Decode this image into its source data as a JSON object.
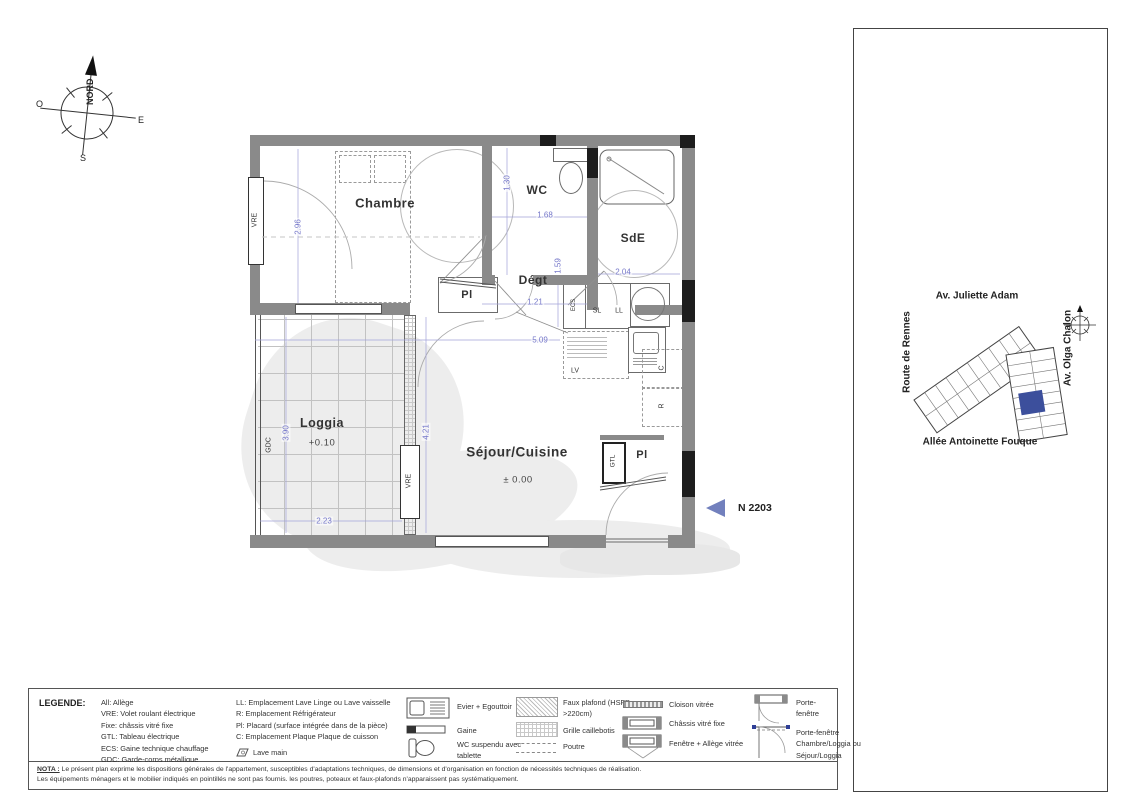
{
  "colors": {
    "logo_purple": "#433d92",
    "dim_blue": "#7577c9",
    "unit_blue": "#5463ae",
    "scalebar_blue": "#2f3f96"
  },
  "compass": {
    "north": "NORD",
    "west": "O",
    "east": "E",
    "south": "S"
  },
  "plan": {
    "rooms": {
      "chambre": "Chambre",
      "wc": "WC",
      "sde": "SdE",
      "degt": "Dégt",
      "sejour": "Séjour/Cuisine",
      "sejour_level": "± 0.00",
      "loggia": "Loggia",
      "loggia_level": "+0.10",
      "pl_chambre": "Pl",
      "pl_entree": "Pl"
    },
    "tags": {
      "vre_left": "VRE",
      "vre_loggia": "VRE",
      "gdc": "GDC",
      "gtl": "GTL",
      "ecs": "ECS",
      "sl": "SL",
      "ll": "LL",
      "lv": "LV",
      "c": "C",
      "r": "R"
    },
    "dims": {
      "chambre_height": "2.96",
      "wc_height": "1.30",
      "wc_width": "1.68",
      "sde_width": "2.04",
      "degt_depth": "1.59",
      "degt_width": "1.21",
      "plan_width": "5.09",
      "loggia_height": "3.90",
      "loggia_width": "2.23",
      "sejour_height": "4.21"
    },
    "unit_marker": "N 2203"
  },
  "panel": {
    "logo_letters": [
      "L",
      "a",
      "ø",
      "m",
      "e"
    ],
    "partners": {
      "bati": "BATI-NANTES",
      "bati_sub": "BÂTISSEURS D'AVENIR",
      "marignan": "Marignan"
    },
    "ilot": "ILOT 1",
    "address": "5 Allée Antoinette Fouque",
    "unit_row": {
      "type": "Type 2",
      "niveau": "Niveau 2",
      "logement": "Logement N 2203"
    },
    "site": {
      "top": "Av. Juliette Adam",
      "left": "Route de Rennes",
      "right": "Av. Olga Chalon",
      "bottom": "Allée Antoinette Fouque"
    },
    "surfaces": {
      "title": "Surfaces habitables",
      "rows": [
        {
          "label": "Séjour/Cuisine",
          "value": "21.05 m²"
        },
        {
          "label": "Chambre",
          "value": "12.25 m²"
        },
        {
          "label": "Dégagement",
          "value": "1.92 m²"
        },
        {
          "label": "Salle d'eau",
          "value": "4.66 m²"
        },
        {
          "label": "WC",
          "value": "2.22 m²"
        }
      ],
      "total_label": "SURFACE TOTALE",
      "total_value": "42.10 m²",
      "loggia_label": "Loggia",
      "loggia_value": "8.69 m²"
    },
    "doc": {
      "title": "PLAN DE VENTE",
      "scale_ticks": [
        "0",
        "1",
        "2",
        "3",
        "4"
      ],
      "edition_label": "Édition:",
      "edition_value": "26 Avril 2023",
      "indice_label": "Indice:",
      "indice_value": "0"
    }
  },
  "legend": {
    "title": "LEGENDE:",
    "abbr1": [
      "All: Allège",
      "VRE: Volet roulant électrique",
      "Fixe: châssis vitré fixe",
      "GTL: Tableau électrique",
      "ECS: Gaine technique chauffage",
      "GDC: Garde-corps métallique"
    ],
    "abbr2": [
      "LL: Emplacement Lave Linge ou Lave vaisselle",
      "R: Emplacement Réfrigérateur",
      "Pl: Placard (surface intégrée dans de la pièce)",
      "C: Emplacement Plaque Plaque de cuisson"
    ],
    "lave_main": "Lave main",
    "sym_evier": "Evier + Egouttoir",
    "sym_gaine": "Gaine",
    "sym_wc": "WC suspendu avec tablette",
    "sym_faux": "Faux plafond (HSFP >220cm)",
    "sym_grille": "Grille caillebotis",
    "sym_poutre": "Poutre",
    "sym_cloison": "Cloison vitrée",
    "sym_chassis": "Châssis vitré fixe",
    "sym_fenetre": "Fenêtre + Allège vitrée",
    "sym_pf": "Porte-fenêtre",
    "sym_pf2": "Porte-fenêtre Chambre/Loggia ou Séjour/Loggia"
  },
  "nota": {
    "label": "NOTA :",
    "line1": "Le présent plan exprime les dispositions générales de l'appartement, susceptibles d'adaptations techniques, de dimensions et d'organisation en fonction de nécessités techniques de réalisation.",
    "line2": "Les équipements ménagers et le mobilier indiqués en pointillés ne sont pas fournis. les poutres, poteaux et faux-plafonds n'apparaissent pas systématiquement."
  }
}
